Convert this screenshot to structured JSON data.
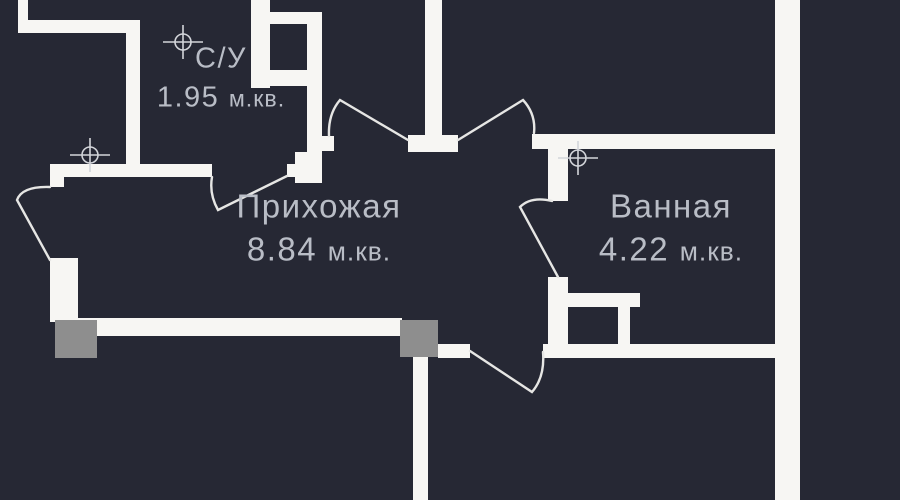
{
  "plan": {
    "type": "apartment-floor-plan",
    "rooms": [
      {
        "id": "su",
        "name": "С/У",
        "area_value": "1.95",
        "area_unit": "м.кв."
      },
      {
        "id": "hallway",
        "name": "Прихожая",
        "area_value": "8.84",
        "area_unit": "м.кв."
      },
      {
        "id": "bathroom",
        "name": "Ванная",
        "area_value": "4.22",
        "area_unit": "м.кв."
      }
    ],
    "colors": {
      "background": "#262834",
      "walls": "#f7f6f3",
      "door_lines": "#e6e6e4",
      "columns": "#8e8e8e",
      "text": "#b9bdc6",
      "axis_markers": "#d3d5da"
    },
    "icons": {
      "axis_marker": "crosshair-circle"
    }
  }
}
